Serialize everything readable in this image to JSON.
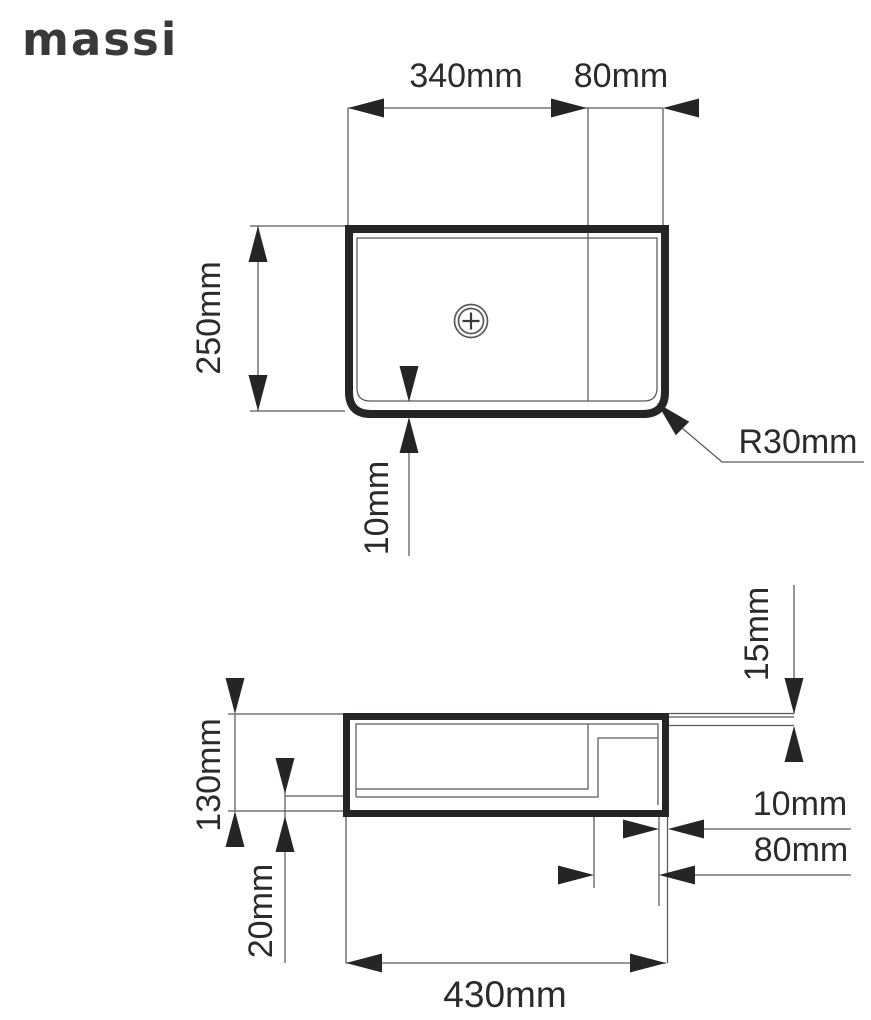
{
  "brand": {
    "name": "massi"
  },
  "colors": {
    "ink": "#262425",
    "thin_line": "#59585b",
    "background": "#ffffff"
  },
  "drawing": {
    "top_view": {
      "width_label": "340mm",
      "shelf_label": "80mm",
      "depth_label": "250mm",
      "wall_label": "10mm",
      "radius_label": "R30mm",
      "drain_icon": "drain-plus-icon"
    },
    "side_view": {
      "deck_label": "15mm",
      "height_label": "130mm",
      "bottom_label": "20mm",
      "wall_label": "10mm",
      "shelf_label": "80mm",
      "length_label": "430mm"
    }
  }
}
